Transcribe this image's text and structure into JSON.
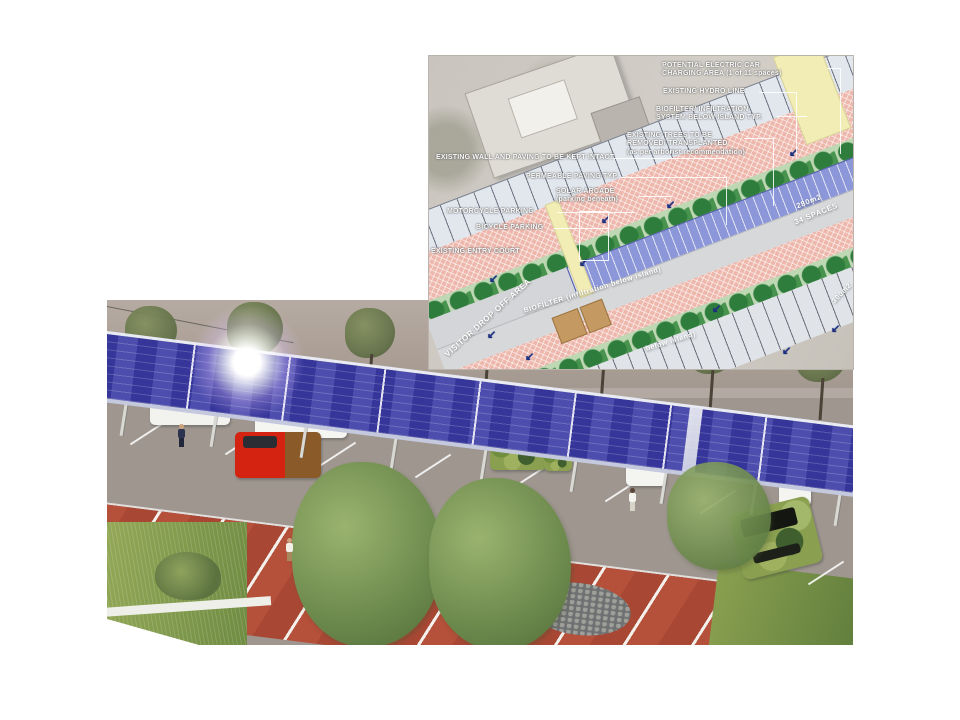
{
  "site_plan": {
    "annotations": [
      {
        "id": "ev-charging",
        "text": "POTENTIAL ELECTRIC CAR\nCHARGING AREA (1 of 11 spaces)"
      },
      {
        "id": "hydro-line",
        "text": "EXISTING HYDRO LINE"
      },
      {
        "id": "biofilter-system",
        "text": "BIOFILTER/ INFILTRATION\nSYSTEM BELOW ISLAND TYP."
      },
      {
        "id": "existing-trees",
        "text": "EXISTING TREES TO BE\nREMOVED/ TRANSPLANTED\n(as per arborist recommendation)"
      },
      {
        "id": "existing-wall",
        "text": "EXISTING WALL AND PAVING TO BE KEPT INTACT"
      },
      {
        "id": "permeable-paving",
        "text": "PERMEABLE PAVING TYP."
      },
      {
        "id": "solar-arcade",
        "text": "SOLAR ARCADE\n(parking beneath)"
      },
      {
        "id": "motorcycle-parking",
        "text": "MOTORCYCLE PARKING"
      },
      {
        "id": "bicycle-parking",
        "text": "BICYCLE PARKING"
      },
      {
        "id": "entry-court",
        "text": "EXISTING ENTRY COURT"
      }
    ],
    "area_labels": [
      {
        "id": "visitor-drop-off",
        "text": "VISITOR DROP OFF AREA"
      },
      {
        "id": "biofilter-island-upper",
        "text": "BIOFILTER (infiltration below island)"
      },
      {
        "id": "solar-area",
        "text": "280m2"
      },
      {
        "id": "solar-spaces",
        "text": "34 SPACES"
      },
      {
        "id": "biofilter-island-lower",
        "text": "below island)"
      },
      {
        "id": "biofilter-area",
        "text": "300m2"
      }
    ]
  },
  "icons": {
    "flow_arrow": "↙"
  },
  "colors": {
    "solar_panel_blue": "#4040a0",
    "plan_solar_band": "#8b97d8",
    "plan_permeable_pink": "#eeb7ac",
    "plan_island_green": "#2f7d3c",
    "plan_path_yellow": "#f2edb5",
    "flow_arrow_navy": "#1d3080",
    "brick_paving_red": "#b5503a",
    "annotation_text": "#ffffff"
  }
}
